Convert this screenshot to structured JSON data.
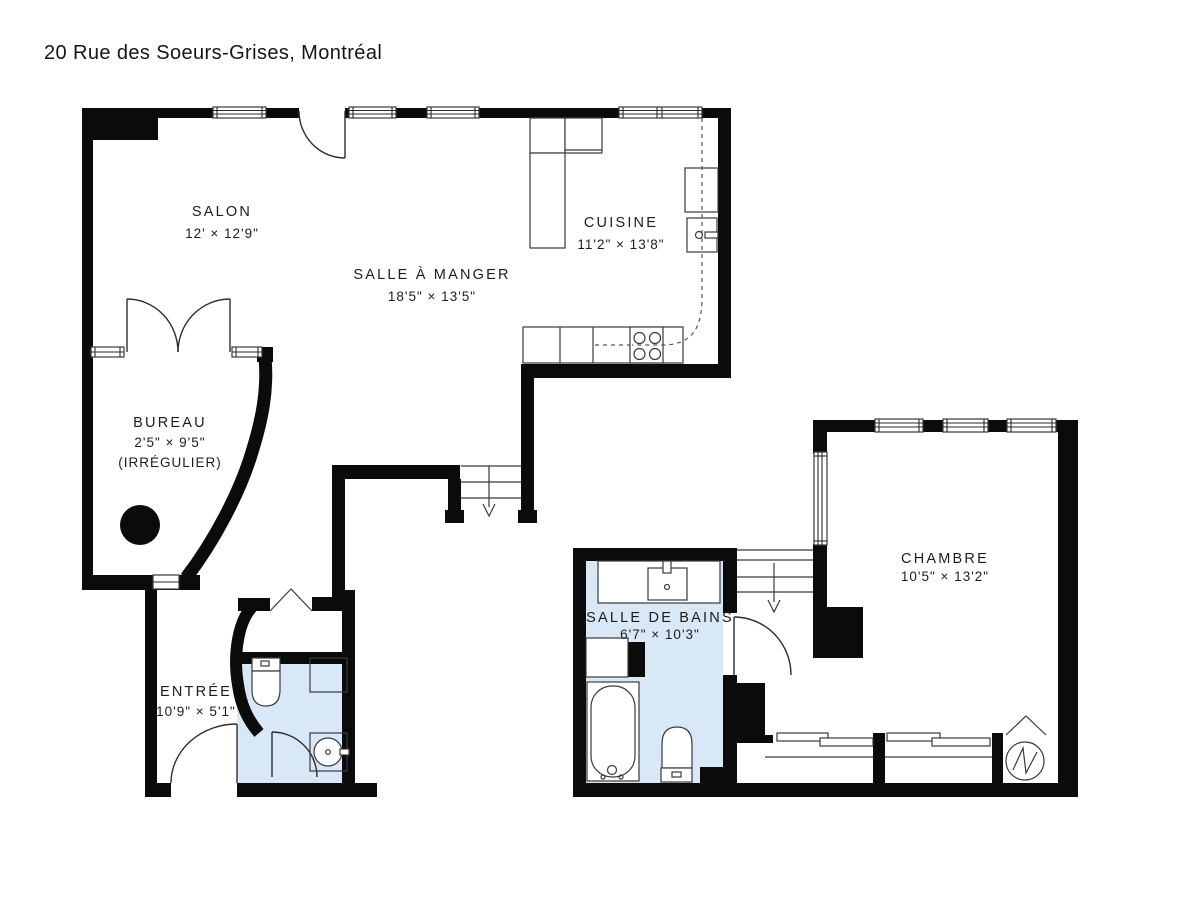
{
  "title": "20 Rue des Soeurs-Grises, Montréal",
  "colors": {
    "wall": "#0b0b0b",
    "bath_fill": "#d9e8f6",
    "line": "#3a3a3a"
  },
  "rooms": {
    "salon": {
      "name": "SALON",
      "dims": "12' × 12'9\""
    },
    "salle_a_manger": {
      "name": "SALLE À MANGER",
      "dims": "18'5\" × 13'5\""
    },
    "cuisine": {
      "name": "CUISINE",
      "dims": "11'2\" × 13'8\""
    },
    "bureau": {
      "name": "BUREAU",
      "dims": "2'5\" × 9'5\"",
      "note": "(IRRÉGULIER)"
    },
    "entree": {
      "name": "ENTRÉE",
      "dims": "10'9\" × 5'1\""
    },
    "salle_de_bains": {
      "name": "SALLE DE BAINS",
      "dims": "6'7\" × 10'3\""
    },
    "chambre": {
      "name": "CHAMBRE",
      "dims": "10'5\" × 13'2\""
    }
  }
}
